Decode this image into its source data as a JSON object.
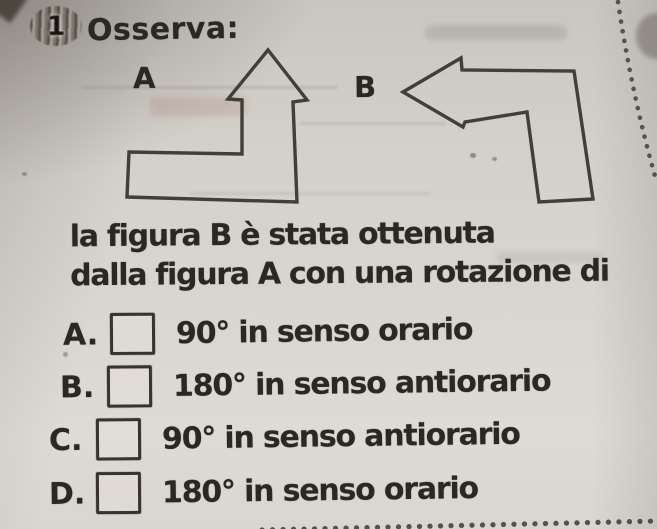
{
  "exercise": {
    "number": "1",
    "title": "Osserva:",
    "figures": {
      "a_label": "A",
      "b_label": "B"
    },
    "prompt": {
      "line1": "la figura B è stata ottenuta",
      "line2": "dalla figura A con una rotazione di"
    },
    "options": [
      {
        "letter": "A.",
        "text": "90° in senso orario",
        "checked": false
      },
      {
        "letter": "B.",
        "text": "180° in senso antiorario",
        "checked": false
      },
      {
        "letter": "C.",
        "text": "90° in senso antiorario",
        "checked": false
      },
      {
        "letter": "D.",
        "text": "180° in senso orario",
        "checked": false
      }
    ],
    "colors": {
      "paper": "#d6d2cc",
      "ink": "#2b2823",
      "figure_stroke": "#3b372f",
      "perforation_dots": "#46433d"
    }
  }
}
